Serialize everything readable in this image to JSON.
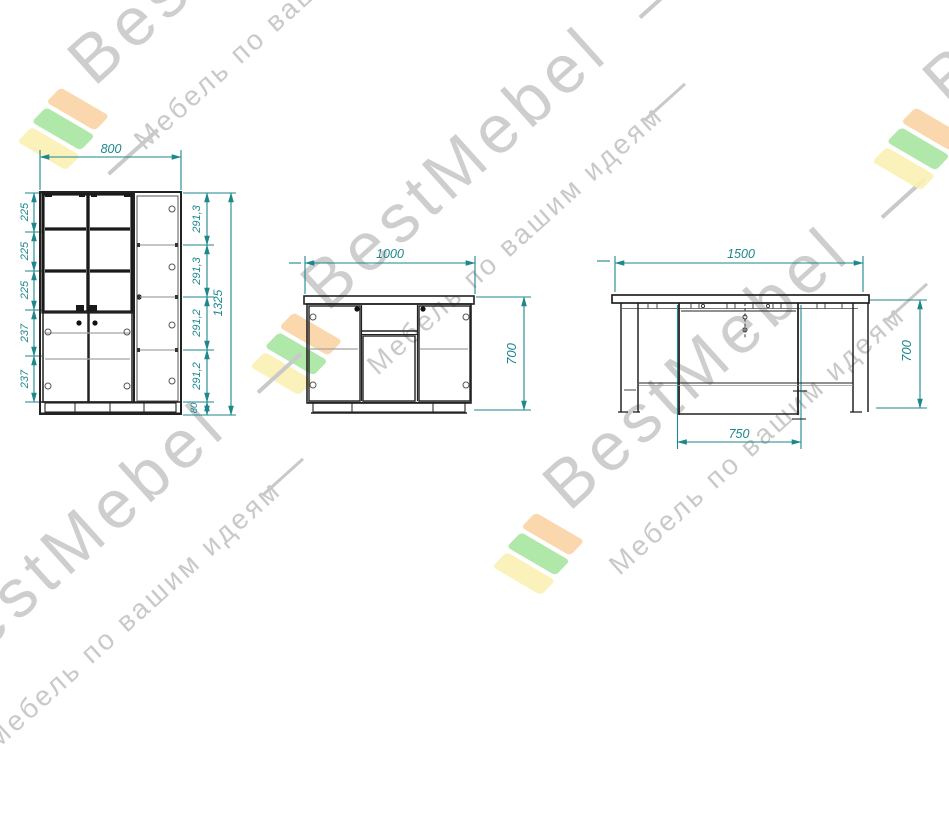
{
  "watermark": {
    "brand": "BestMebel",
    "tagline": "Мебель по вашим идеям",
    "text_color": "#c6c6c6",
    "logo_colors": {
      "yellow": "#f9efb4",
      "green": "#a6e5a0",
      "orange": "#fbd3a4"
    }
  },
  "drawing": {
    "accent_color": "#1d878c",
    "line_color": "#222222",
    "cabinet": {
      "width": "800",
      "height_total": "1325",
      "left_dims": [
        "225",
        "225",
        "225",
        "237",
        "237"
      ],
      "right_dims": [
        "291,3",
        "291,3",
        "291,2",
        "291,2"
      ],
      "plinth_height": "80"
    },
    "tumba": {
      "width": "1000",
      "height": "700"
    },
    "table": {
      "width": "1500",
      "height": "700",
      "inner_width": "750"
    }
  }
}
